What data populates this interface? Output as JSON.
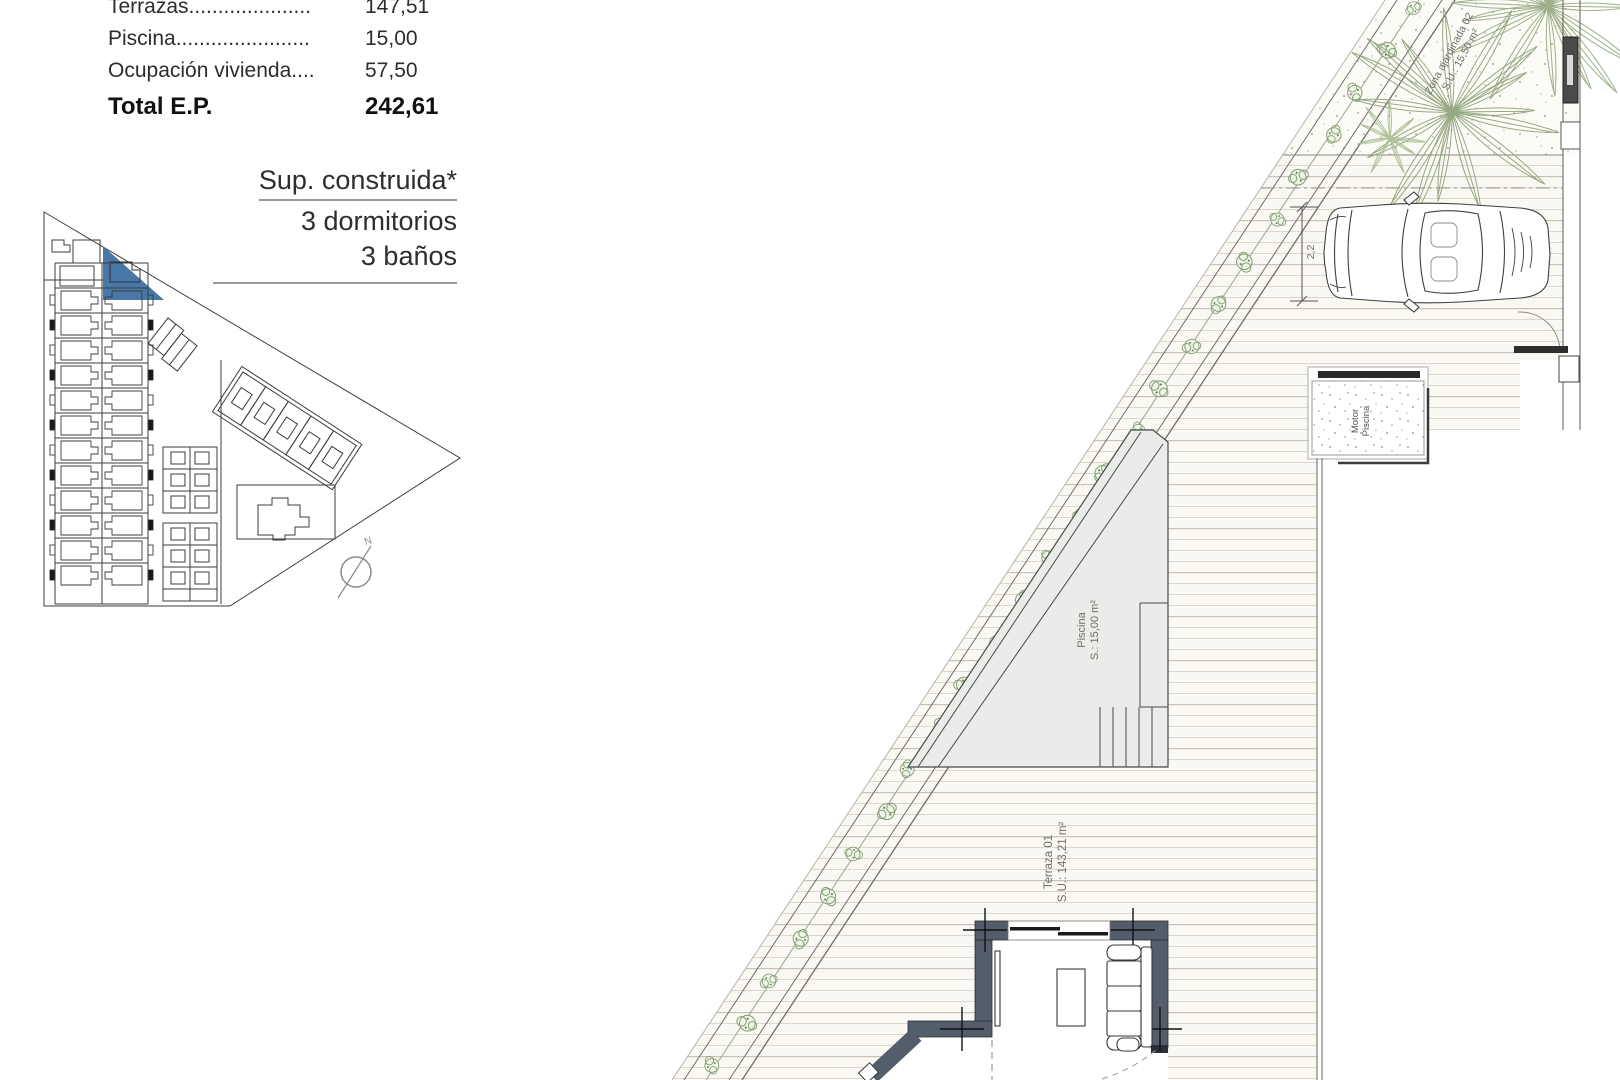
{
  "panel": {
    "rows": [
      {
        "label": "Terrazas.....................",
        "value": "147,51"
      },
      {
        "label": "Piscina.......................",
        "value": "15,00"
      },
      {
        "label": "Ocupación vivienda....",
        "value": "57,50"
      }
    ],
    "total_label": "Total E.P.",
    "total_value": "242,61",
    "sup_title": "Sup. construida*",
    "bedrooms": "3 dormitorios",
    "bathrooms": "3 baños"
  },
  "plan": {
    "pool_label": "Piscina",
    "pool_area": "S.: 15,00 m²",
    "terrace_label": "Terraza 01",
    "terrace_area": "S.U.: 143,21 m²",
    "garden_label": "Zona ajardinada 02",
    "garden_area": "S.U.: 15,50 m²",
    "motor_label_1": "Motor",
    "motor_label_2": "Piscina",
    "parking_dim": "2,2"
  },
  "keymap": {
    "north_label": "N",
    "highlight_color": "#4878a8"
  },
  "colors": {
    "wall": "#535d6b",
    "pool_fill": "#e9ece8",
    "hedge_green": "#86a173",
    "deck_line": "#d9d5ca"
  }
}
